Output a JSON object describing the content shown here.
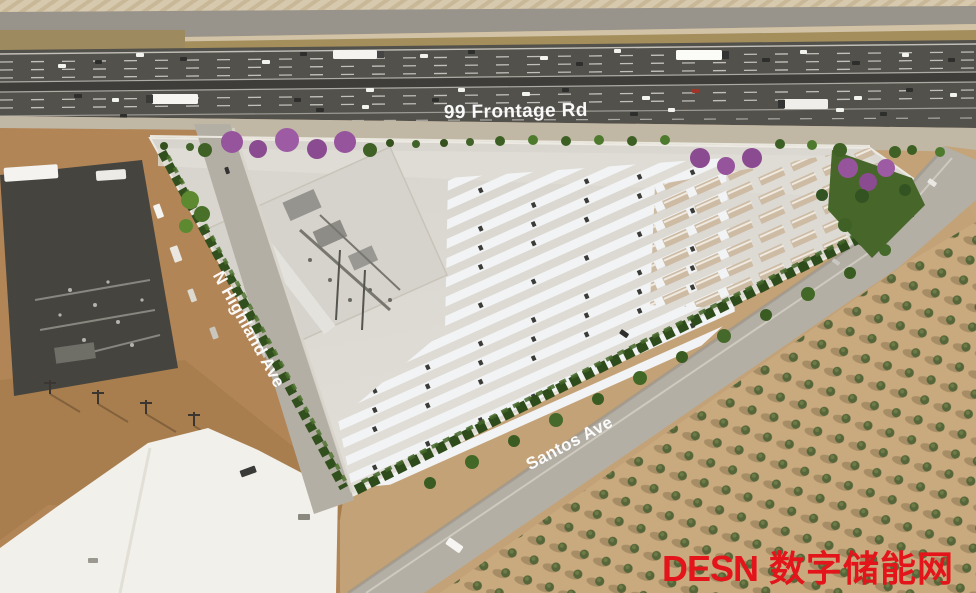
{
  "labels": {
    "frontage_road": "99 Frontage Rd",
    "highland_ave": "N Highland Ave",
    "santos_ave": "Santos Ave"
  },
  "watermark": {
    "brand": "DESN",
    "cn": "数字储能网",
    "color": "#e3141a"
  },
  "palette": {
    "highway_asphalt": "#53514c",
    "frontage_asphalt": "#5b5954",
    "shoulder": "#c0b7a5",
    "site_pad": "#dbd8d2",
    "battery_container_white": "#f2f3f4",
    "transformer_tan": "#cdbba4",
    "substation_gravel": "#d6d3cc",
    "hedge_green": "#32501d",
    "tree_green": "#3f6125",
    "purple_tree": "#96549c",
    "orchard_ground": "#c9aa7e",
    "orchard_tree": "#57663a",
    "dirt": "#b28557",
    "white_pad": "#f2f0ea",
    "road_gray": "#b4afa5",
    "label_white": "#ffffff"
  }
}
